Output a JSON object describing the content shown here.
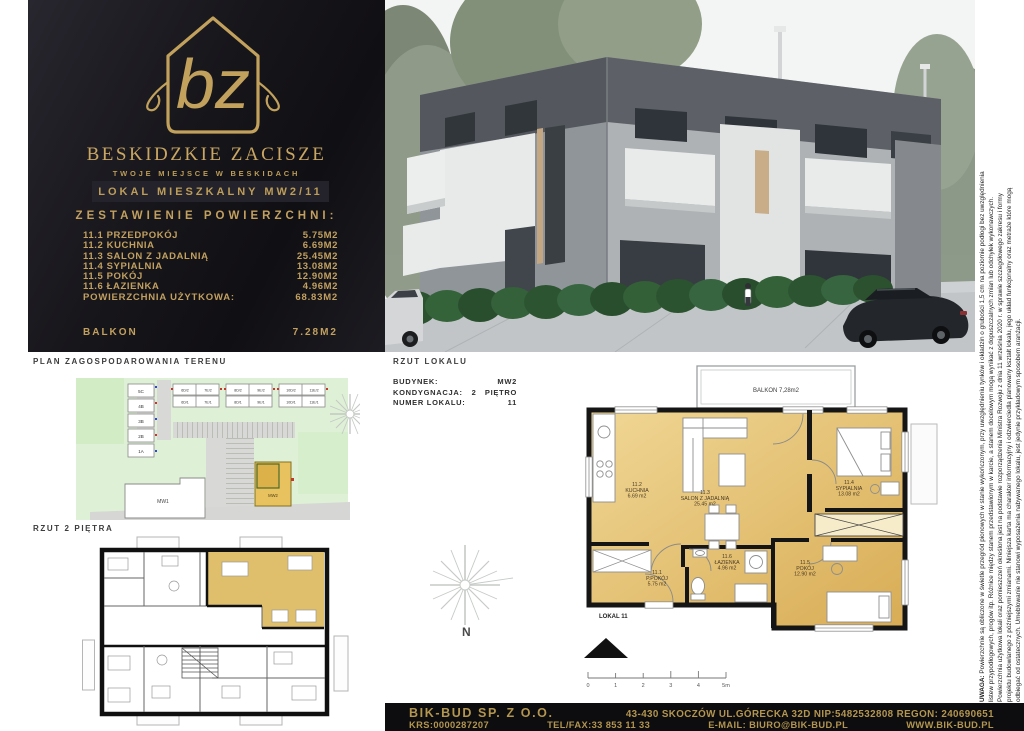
{
  "colors": {
    "gold": "#c2a05f",
    "panel_black": "#17161b",
    "footer_gold": "#b3964f",
    "plan_gold": "#e8c878",
    "site_green": "#def0d6"
  },
  "brand": {
    "monogram": "bz",
    "name": "BESKIDZKIE ZACISZE",
    "tagline": "TWOJE MIEJSCE W BESKIDACH",
    "unit_title": "LOKAL MIESZKALNY MW2/11",
    "areas_heading": "ZESTAWIENIE POWIERZCHNI:",
    "rooms": [
      {
        "label": "11.1 PRZEDPOKÓJ",
        "area": "5.75M2"
      },
      {
        "label": "11.2 KUCHNIA",
        "area": "6.69M2"
      },
      {
        "label": "11.3 SALON Z JADALNIĄ",
        "area": "25.45M2"
      },
      {
        "label": "11.4 SYPIALNIA",
        "area": "13.08M2"
      },
      {
        "label": "11.5 POKÓJ",
        "area": "12.90M2"
      },
      {
        "label": "11.6 ŁAZIENKA",
        "area": "4.96M2"
      }
    ],
    "total_label": "POWIERZCHNIA UŻYTKOWA:",
    "total_area": "68.83M2",
    "balcony_label": "BALKON",
    "balcony_area": "7.28M2"
  },
  "site_plan": {
    "title": "PLAN ZAGOSPODAROWANIA TERENU",
    "row_houses": [
      "5C",
      "4B",
      "3B",
      "2B",
      "1A"
    ],
    "duplex_labels": [
      "6D/2",
      "7E/2",
      "6D/1",
      "7E/1",
      "8D/2",
      "9E/2",
      "8D/1",
      "9E/1",
      "10D/2",
      "11E/2",
      "10D/1",
      "11E/1"
    ],
    "mw1": "MW1",
    "mw2": "MW2"
  },
  "floor_plan": {
    "title": "RZUT 2 PIĘTRA"
  },
  "unit_plan": {
    "title": "RZUT LOKALU",
    "info": [
      {
        "label": "BUDYNEK:",
        "value": "MW2"
      },
      {
        "label": "KONDYGNACJA:",
        "value": "2   PIĘTRO"
      },
      {
        "label": "NUMER LOKALU:",
        "value": "11"
      }
    ],
    "balcony": "BALKON 7,28m2",
    "lokal_label": "LOKAL 11",
    "north": "N",
    "rooms": [
      {
        "id": "11.1",
        "name": "P.POKÓJ",
        "area": "5.75 m2"
      },
      {
        "id": "11.2",
        "name": "KUCHNIA",
        "area": "6.69 m2"
      },
      {
        "id": "11.3",
        "name": "SALON Z JADALNIĄ",
        "area": "25.45 m2"
      },
      {
        "id": "11.4",
        "name": "SYPIALNIA",
        "area": "13.08 m2"
      },
      {
        "id": "11.5",
        "name": "POKÓJ",
        "area": "12.90 m2"
      },
      {
        "id": "11.6",
        "name": "ŁAZIENKA",
        "area": "4.96 m2"
      }
    ],
    "scale": [
      "0",
      "1",
      "2",
      "3",
      "4",
      "5m"
    ]
  },
  "disclaimer": {
    "label": "UWAGA:",
    "lines": [
      "Powierzchnie są obliczone w świetle przegród pionowych w stanie wykończonym, przy uwzględnieniu tynków i okładzin o grubości 1,5 cm na poziomie podłogi bez uwzględnienia",
      "listew przypodłogowych, progów itp. Różnice między stanem przedstawionym w karcie, a stanem docelowym mogą wynikać z dopuszczalnych zmian lub odchyłek wykonawczych.",
      "Powierzchnia użytkowa lokali oraz pomieszczeń określona jest na podstawie rozporządzenia Ministra Rozwoju z dnia 11 września 2020 r. w sprawie szczegółowego zakresu i formy",
      "projektu budowlanego z późniejszymi zmianami. Niniejsza karta ma charakter informacyjny i odzwierciedla planowany kształt lokalu, jego układ funkcjonalny oraz metraże które mogą",
      "odbiegać od ostatecznych. Umeblowanie nie stanowi wyposażenia nabywanego lokalu, jest jedynie przykładowym sposobem aranżacji."
    ]
  },
  "footer": {
    "company": "BIK-BUD SP. Z O.O.",
    "address_line": "43-430 SKOCZÓW UL.GÓRECKA 32D NIP:5482532808 REGON: 240690651",
    "krs": "KRS:0000287207",
    "phone": "TEL/FAX:33 853 11 33",
    "email": "E-MAIL: BIURO@BIK-BUD.PL",
    "website": "WWW.BIK-BUD.PL"
  }
}
